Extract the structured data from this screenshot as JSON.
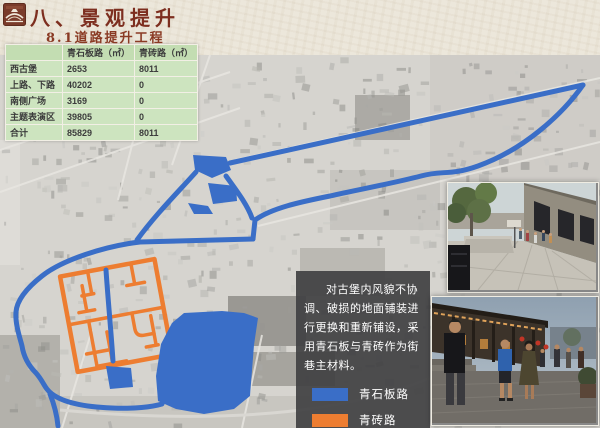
{
  "header": {
    "title": "八、景观提升",
    "subtitle": "8.1道路提升工程"
  },
  "table": {
    "col_headers": [
      "青石板路（㎡）",
      "青砖路（㎡）"
    ],
    "rows": [
      {
        "label": "西古堡",
        "stone": "2653",
        "brick": "8011"
      },
      {
        "label": "上路、下路",
        "stone": "40202",
        "brick": "0"
      },
      {
        "label": "南侧广场",
        "stone": "3169",
        "brick": "0"
      },
      {
        "label": "主题表演区",
        "stone": "39805",
        "brick": "0"
      },
      {
        "label": "合计",
        "stone": "85829",
        "brick": "8011"
      }
    ]
  },
  "infobox": {
    "text": "对古堡内风貌不协调、破损的地面铺装进行更换和重新铺设，采用青石板与青砖作为街巷主材料。"
  },
  "legend": {
    "items": [
      {
        "label": "青石板路",
        "color": "#3a6ec7"
      },
      {
        "label": "青砖路",
        "color": "#ed7d31"
      }
    ]
  },
  "colors": {
    "route_blue": "#3a6ec7",
    "route_orange": "#ed7d31",
    "title_color": "#7d2e1f",
    "infobox_bg": "rgba(64,64,66,0.92)",
    "table_green": "#cde4bf"
  }
}
